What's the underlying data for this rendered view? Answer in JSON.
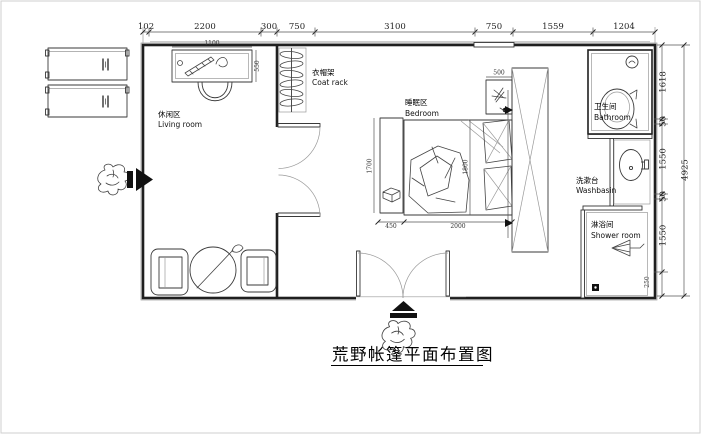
{
  "title": "荒野帐篷平面布置图",
  "dims": {
    "top": [
      "102",
      "2200",
      "300",
      "750",
      "3100",
      "750",
      "1559",
      "1204"
    ],
    "right": [
      "1618",
      "50",
      "1550",
      "50",
      "1550"
    ],
    "right_total": "4925",
    "right_small": "250"
  },
  "rooms": {
    "living": {
      "zh": "休闲区",
      "en": "Living room"
    },
    "coatrack": {
      "zh": "衣帽架",
      "en": "Coat rack"
    },
    "bedroom": {
      "zh": "睡眠区",
      "en": "Bedroom"
    },
    "bathroom": {
      "zh": "卫生间",
      "en": "Bathroom"
    },
    "washbasin": {
      "zh": "洗漱台",
      "en": "Washbasin"
    },
    "shower": {
      "zh": "淋浴间",
      "en": "Shower room"
    }
  },
  "furniture_dims": {
    "desk_width": "1100",
    "desk_depth": "550",
    "side_table": "500",
    "bed_side_left": "1700",
    "bed_side_right": "1800",
    "bed_width": "2000",
    "bench_width": "450"
  },
  "icons": {
    "left_entrance_arrow": "►",
    "bottom_entrance_arrow": "▲"
  },
  "colors": {
    "wall": "#1f1f1f",
    "dim_line": "#555555",
    "light_line": "#9a9a9a",
    "paper": "#ffffff"
  }
}
